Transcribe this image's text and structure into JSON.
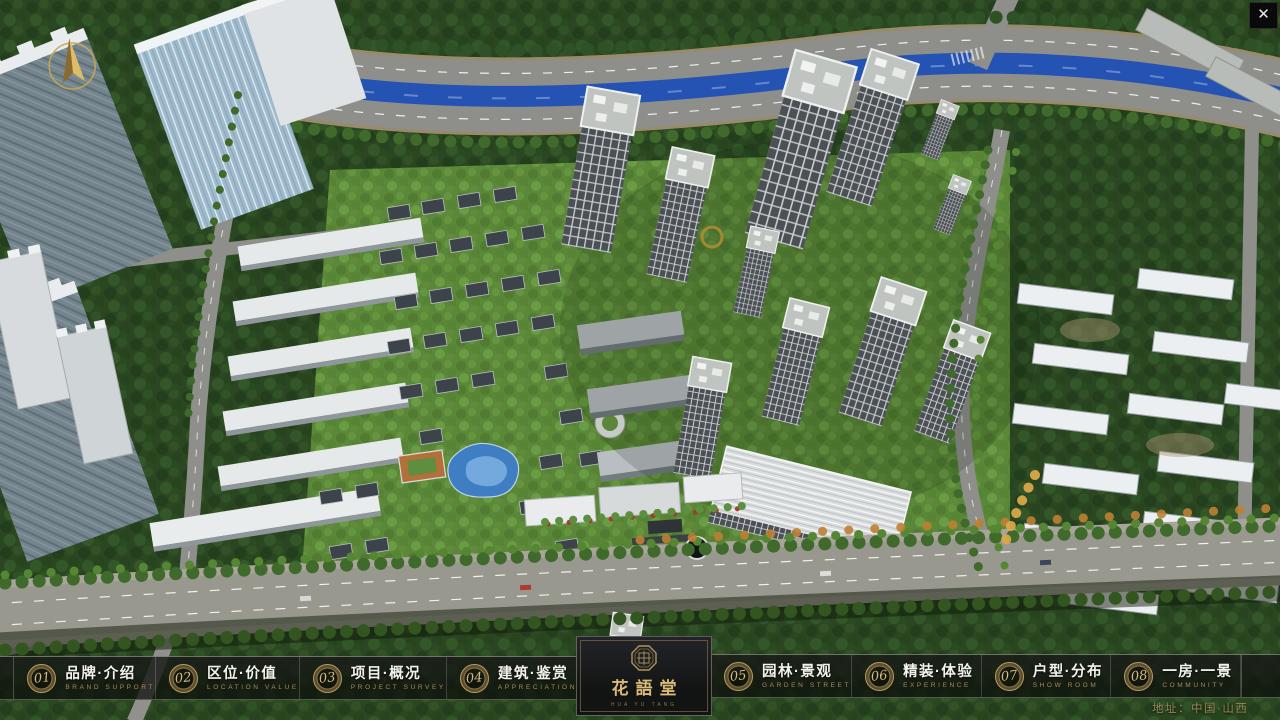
{
  "window": {
    "close_icon": "✕"
  },
  "project": {
    "logo_name": "花語堂",
    "logo_tagline": "HUA YU TANG",
    "address_label": "地址：中国·山西"
  },
  "nav": {
    "items": [
      {
        "number": "01",
        "title": "品牌·介绍",
        "subtitle": "BRAND SUPPORT"
      },
      {
        "number": "02",
        "title": "区位·价值",
        "subtitle": "LOCATION VALUE"
      },
      {
        "number": "03",
        "title": "项目·概况",
        "subtitle": "PROJECT SURVEY"
      },
      {
        "number": "04",
        "title": "建筑·鉴赏",
        "subtitle": "APPRECIATION"
      },
      {
        "number": "05",
        "title": "园林·景观",
        "subtitle": "GARDEN STREET"
      },
      {
        "number": "06",
        "title": "精装·体验",
        "subtitle": "EXPERIENCE"
      },
      {
        "number": "07",
        "title": "户型·分布",
        "subtitle": "SHOW ROOM"
      },
      {
        "number": "08",
        "title": "一房·一景",
        "subtitle": "COMMUNITY"
      }
    ]
  },
  "colors": {
    "accent_gold": "#c8a552",
    "title_white": "#f3f2ed",
    "subtitle_gold": "#a38c58",
    "bar_background": "rgba(12,14,11,0.78)",
    "river_blue": "#2553b4",
    "canopy_green": "#2c4a24"
  }
}
